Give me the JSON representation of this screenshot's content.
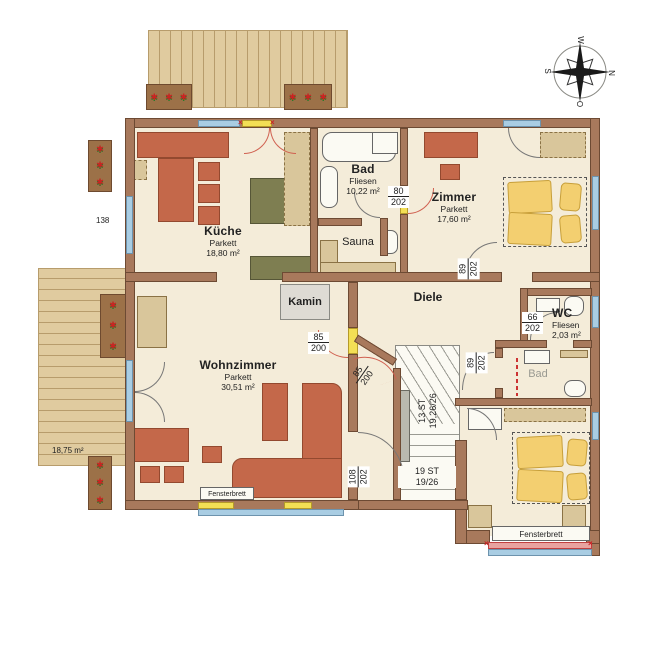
{
  "compass": {
    "n": "N",
    "o": "O",
    "s": "S",
    "w": "W"
  },
  "rooms": {
    "kueche": {
      "name": "Küche",
      "floor": "Parkett",
      "area": "18,80 m²"
    },
    "bad": {
      "name": "Bad",
      "floor": "Fliesen",
      "area": "10,22 m²"
    },
    "sauna": {
      "name": "Sauna"
    },
    "zimmer": {
      "name": "Zimmer",
      "floor": "Parkett",
      "area": "17,60 m²"
    },
    "diele": {
      "name": "Diele"
    },
    "wc": {
      "name": "WC",
      "floor": "Fliesen",
      "area": "2,03 m²"
    },
    "bad_klein": {
      "name": "Bad"
    },
    "wohnzimmer": {
      "name": "Wohnzimmer",
      "floor": "Parkett",
      "area": "30,51 m²"
    },
    "kamin": {
      "name": "Kamin"
    }
  },
  "doors": {
    "bad": {
      "w": "80",
      "h": "202"
    },
    "zimmer": {
      "w": "89",
      "h": "202"
    },
    "wc": {
      "w": "66",
      "h": "202"
    },
    "bad_klein": {
      "w": "89",
      "h": "202"
    },
    "wohnzimmer": {
      "w": "85",
      "h": "200"
    },
    "treppe": {
      "w": "85",
      "h": "200"
    },
    "flur": {
      "w": "108",
      "h": "202"
    }
  },
  "stairs": {
    "upper_count": "13 ST",
    "upper_dim": "19,26/26",
    "lower_count": "19 ST",
    "lower_dim": "19/26"
  },
  "annotations": {
    "fensterbrett": "Fensterbrett",
    "window_width": "138",
    "terrace_area": "18,75 m²"
  },
  "colors": {
    "wall": "#a8795c",
    "floor": "#f4ecd9",
    "window": "#a9cde3",
    "door_highlight": "#f3df55",
    "furniture": "#c4684a",
    "kitchen_unit": "#7e7e51",
    "bed": "#f3cf70",
    "deck": "#e0cb9f",
    "swing": "#d06050"
  }
}
